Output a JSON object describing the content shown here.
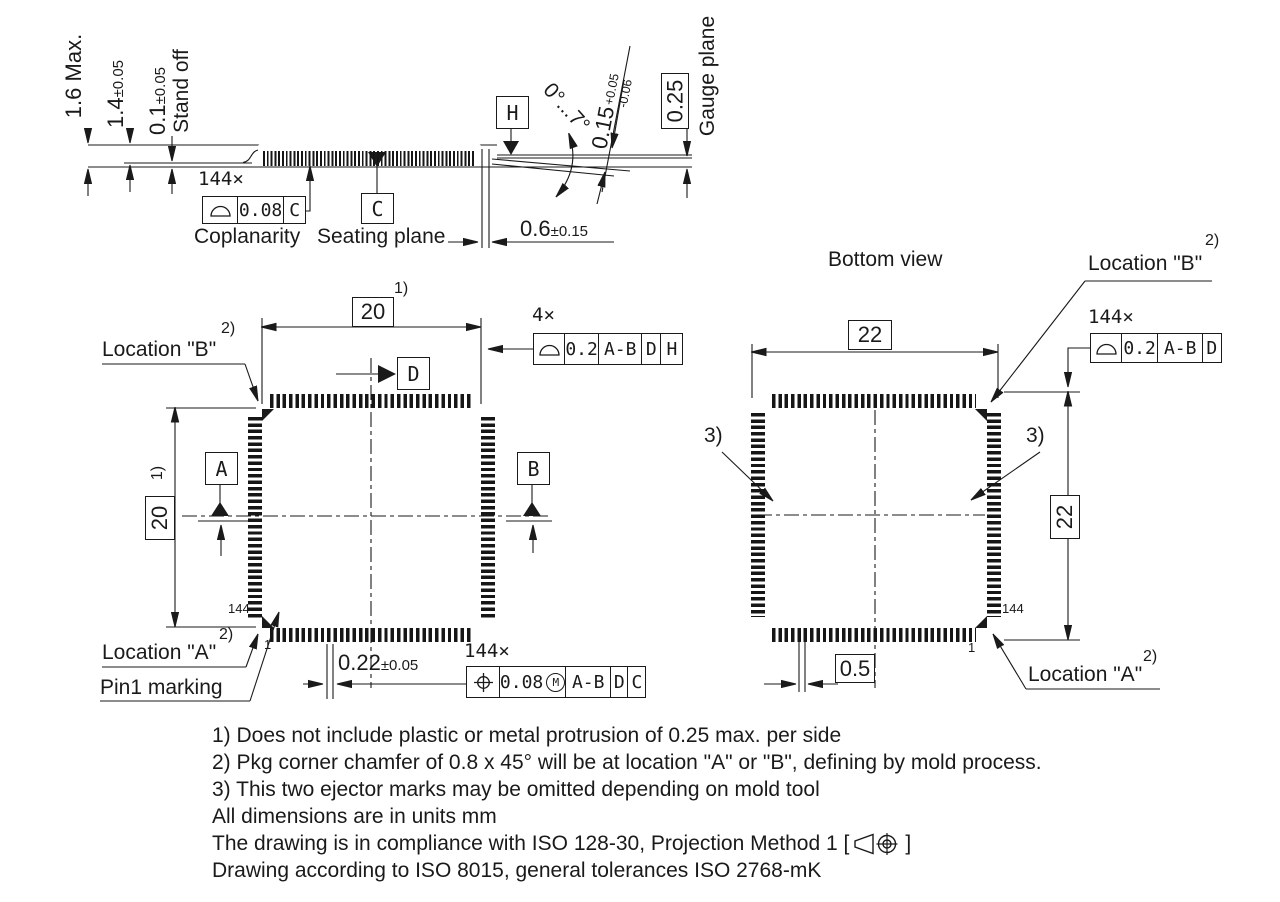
{
  "side": {
    "h_max": "1.6 Max.",
    "body_t": "1.4",
    "body_t_tol": "±0.05",
    "standoff": "0.1",
    "standoff_tol": "±0.05",
    "standoff_label": "Stand off",
    "count": "144×",
    "cop_val": "0.08",
    "cop_datum": "C",
    "cop_label": "Coplanarity",
    "datum_c": "C",
    "seating_label": "Seating plane",
    "foot_len": "0.6",
    "foot_len_tol": "±0.15",
    "datum_h": "H",
    "angle": "0°...7°",
    "lead_t": "0.15",
    "lead_t_plus": "+0.05",
    "lead_t_minus": "-0.06",
    "gauge_off": "0.25",
    "gauge_label": "Gauge plane"
  },
  "top": {
    "dim_w": "20",
    "dim_w_ref": "1)",
    "dim_h": "20",
    "dim_h_ref": "1)",
    "loc_b": "Location \"B\"",
    "loc_b_ref": "2)",
    "loc_a": "Location \"A\"",
    "loc_a_ref": "2)",
    "pin1_label": "Pin1 marking",
    "datum_a": "A",
    "datum_b": "B",
    "datum_d": "D",
    "fcf_profile": {
      "count": "4×",
      "value": "0.2",
      "d1": "A-B",
      "d2": "D",
      "d3": "H"
    },
    "fcf_position": {
      "count": "144×",
      "value": "0.08",
      "mod": "M",
      "d1": "A-B",
      "d2": "D",
      "d3": "C"
    },
    "pitch": "0.22",
    "pitch_tol": "±0.05",
    "pin_last": "144",
    "pin_first": "1"
  },
  "bottom": {
    "title": "Bottom view",
    "dim_w": "22",
    "dim_h": "22",
    "loc_b": "Location \"B\"",
    "loc_b_ref": "2)",
    "loc_a": "Location \"A\"",
    "loc_a_ref": "2)",
    "fcf_profile": {
      "count": "144×",
      "value": "0.2",
      "d1": "A-B",
      "d2": "D"
    },
    "ejector_ref_left": "3)",
    "ejector_ref_right": "3)",
    "lead_w": "0.5",
    "pin_last": "144",
    "pin_first": "1"
  },
  "notes": {
    "n1": "1) Does not include plastic or metal protrusion of 0.25 max. per side",
    "n2": "2) Pkg corner chamfer of 0.8 x 45° will be at location \"A\" or \"B\", defining by mold process.",
    "n3": "3) This two ejector marks may be omitted depending on mold tool",
    "n4": "All dimensions are in units mm",
    "n5_prefix": "The drawing is in compliance with ISO 128-30, Projection Method 1 [",
    "n5_suffix": "]",
    "n6": "Drawing according to ISO 8015, general tolerances ISO 2768-mK"
  }
}
